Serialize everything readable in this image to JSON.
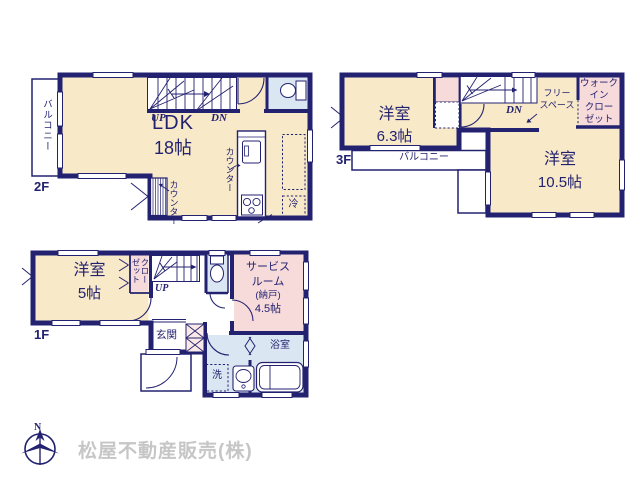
{
  "colors": {
    "wall_navy": "#232270",
    "room_cream": "#f8e9c8",
    "room_pink": "#f7dada",
    "room_blue": "#dbe6f3",
    "company_gray": "#c6c6c6"
  },
  "floor2": {
    "label": "2F",
    "balcony": "バルコニー",
    "ldk": "LDK",
    "ldk_size": "18帖",
    "up": "UP",
    "dn": "DN",
    "counter_kitchen": "カウンター",
    "counter_wall": "カウンター",
    "fridge": "冷"
  },
  "floor3": {
    "label": "3F",
    "room1": "洋室",
    "room1_size": "6.3帖",
    "room2": "洋室",
    "room2_size": "10.5帖",
    "dn": "DN",
    "free_space": [
      "フリー",
      "スペース"
    ],
    "wic": [
      "ウォーク",
      "イン",
      "クロー",
      "ゼット"
    ],
    "balcony": "バルコニー"
  },
  "floor1": {
    "label": "1F",
    "room": "洋室",
    "room_size": "5帖",
    "closet": [
      "クロー",
      "ゼット"
    ],
    "up": "UP",
    "service_room": [
      "サービス",
      "ルーム",
      "(納戸)",
      "4.5帖"
    ],
    "entrance": "玄関",
    "bathroom": "浴室",
    "laundry": "洗"
  },
  "footer": {
    "compass_north": "N",
    "company": "松屋不動産販売(株)"
  }
}
